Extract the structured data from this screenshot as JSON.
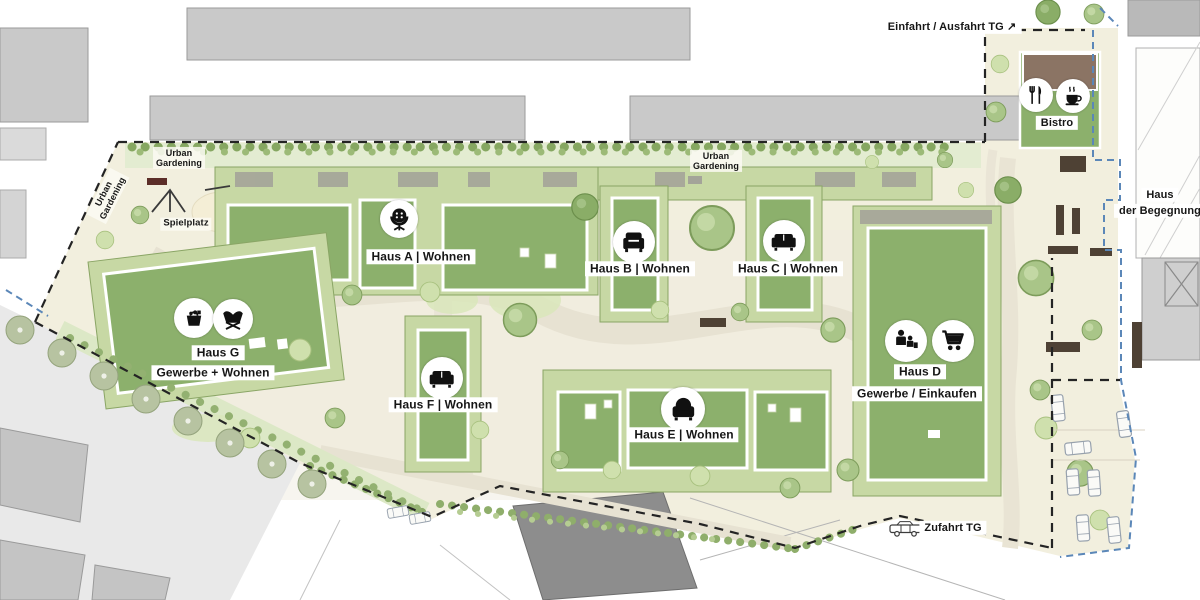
{
  "boundary_labels": {
    "entrance_exit_tg": "Einfahrt / Ausfahrt TG ↗",
    "zufahrt_tg": "Zufahrt TG"
  },
  "amenities": {
    "bistro": "Bistro",
    "spielplatz": "Spielplatz",
    "urban_gardening_line1": "Urban",
    "urban_gardening_line2": "Gardening",
    "haus_der_begegnung_line1": "Haus",
    "haus_der_begegnung_line2": "der Begegnung"
  },
  "houses": {
    "a": {
      "label": "Haus A | Wohnen",
      "icon": "pedestal-chair"
    },
    "b": {
      "label": "Haus B | Wohnen",
      "icon": "armchair"
    },
    "c": {
      "label": "Haus C | Wohnen",
      "icon": "sofa"
    },
    "d": {
      "name": "Haus D",
      "subtitle": "Gewerbe / Einkaufen",
      "icons": [
        "family",
        "shopping-cart"
      ]
    },
    "e": {
      "label": "Haus E | Wohnen",
      "icon": "round-armchair"
    },
    "f": {
      "label": "Haus F | Wohnen",
      "icon": "sofa"
    },
    "g": {
      "name": "Haus G",
      "subtitle": "Gewerbe + Wohnen",
      "icons": [
        "shopping-basket",
        "lounge-chair"
      ]
    }
  },
  "bistro_icons": [
    "fork-knife",
    "coffee-cup"
  ],
  "colors": {
    "site_ground": "#f2efde",
    "roof_green": "#8cb06c",
    "building_base_green": "#c7d8a4",
    "context_gray": "#c9c9c9",
    "boundary_black": "#242424",
    "boundary_blue": "#5b87b8",
    "tree_green": "#a9c588"
  }
}
